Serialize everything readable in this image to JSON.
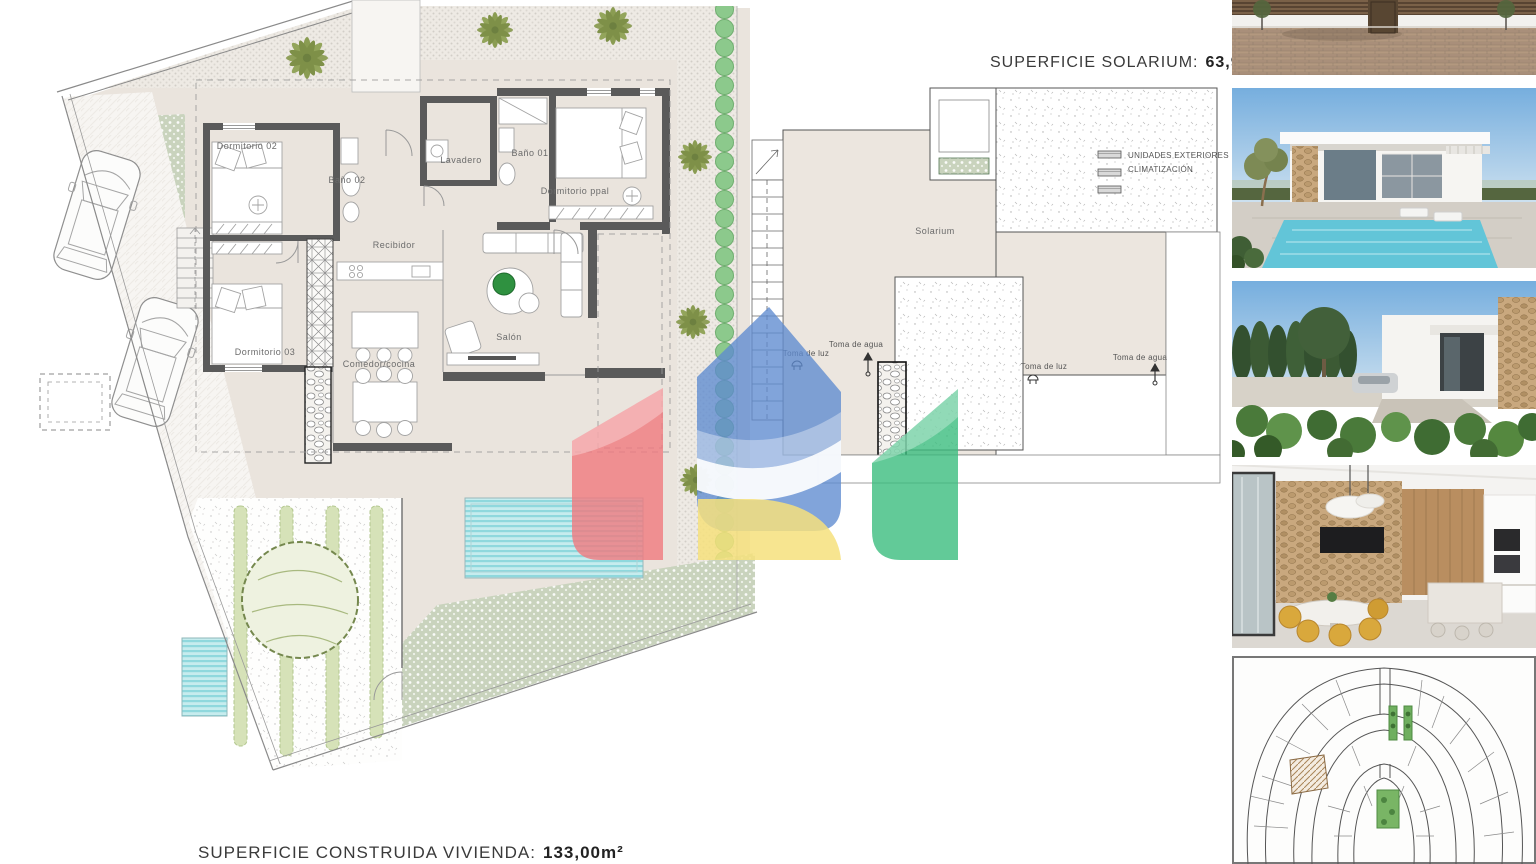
{
  "header": {
    "solarium_title_label": "SUPERFICIE SOLARIUM:",
    "solarium_title_value": "63,94m²"
  },
  "footer": {
    "vivienda_title_label": "SUPERFICIE CONSTRUIDA VIVIENDA:",
    "vivienda_title_value": "133,00m²"
  },
  "floor_plan": {
    "rooms": {
      "dormitorio02": "Dormitorio 02",
      "bano02": "Baño 02",
      "lavadero": "Lavadero",
      "bano01": "Baño 01",
      "dormitorio_ppal": "Dormitorio ppal",
      "recibidor": "Recibidor",
      "dormitorio03": "Dormitorio 03",
      "comedor_cocina": "Comedor/cocina",
      "salon": "Salón"
    }
  },
  "solarium_plan": {
    "room_label": "Solarium",
    "hvac_line1": "UNIDADES EXTERIORES",
    "hvac_line2": "CLIMATIZACIÓN",
    "water_point_label": "Toma de agua",
    "light_point_label": "Toma de luz"
  },
  "colors": {
    "logo_blue": "#5d8bd0",
    "logo_red": "#f0797e",
    "logo_yellow": "#f6e07d",
    "logo_green": "#3bbd7e",
    "pool_water": "#8fd8dd",
    "hedge_green": "#8cc98c",
    "ground_beige": "#eae4dd",
    "wall_gray": "#5a5a5a"
  },
  "photos": [
    {
      "name": "street-facade-photo"
    },
    {
      "name": "villa-pool-render-photo"
    },
    {
      "name": "villa-garden-render-photo"
    },
    {
      "name": "kitchen-interior-render-photo"
    },
    {
      "name": "urbanization-site-plan"
    }
  ]
}
